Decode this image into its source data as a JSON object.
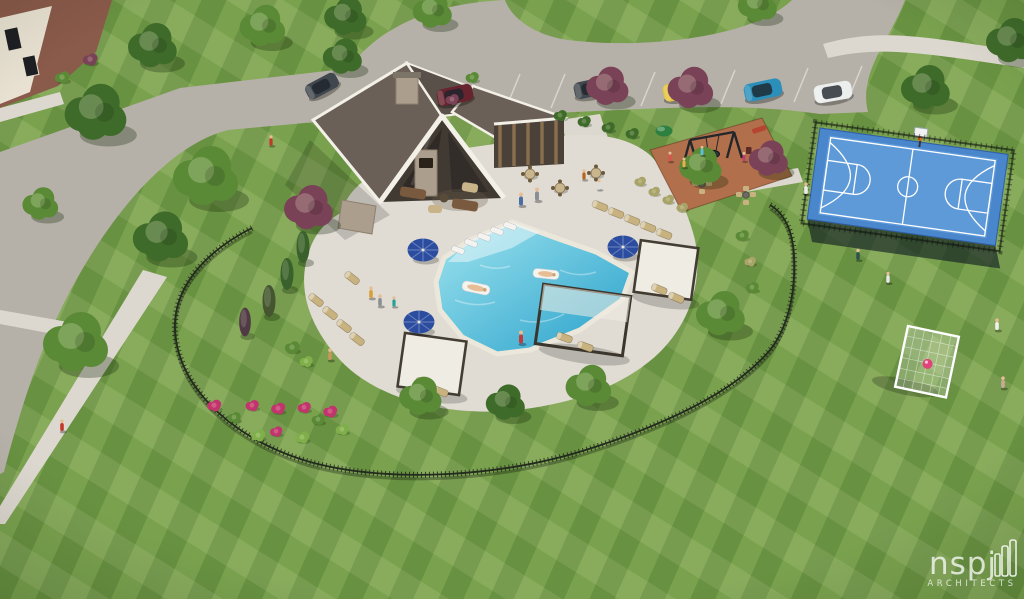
{
  "image": {
    "alt": "Aerial architectural rendering of a community amenity center: clubhouse with gabled roofs, resort-style pool with tanning ledge, blue umbrellas and cabanas, playground, blue basketball sport court, soccer goal lawn, parking with cars, and striped mown lawns"
  },
  "watermark": {
    "name": "nspj",
    "tagline": "ARCHITECTS"
  },
  "palette": {
    "lawn": "#7aa24e",
    "road": "#b6b1a8",
    "sidewalk": "#ddd8cf",
    "deck": "#e0dcd4",
    "pool_shallow": "#9fe4ee",
    "pool_deep": "#27a0cb",
    "coping": "#ece7db",
    "court": "#4a86cc",
    "court_light": "#5e9ad8",
    "court_line": "#ffffff",
    "roof": "#6b6057",
    "roof_dark": "#59504a",
    "trim": "#f3f0e8",
    "wall": "#413a33",
    "stone": "#ab9e8c",
    "wood": "#8a6f4e",
    "mulch": "#b16f4b",
    "umbrella": "#2c4d9f",
    "fence": "#232a1e",
    "lounger": "#c7b280",
    "canopy": "#f0ede4",
    "tree": "#5a8a36",
    "tree_dark": "#3f6b2a",
    "tree_purple": "#7a4257",
    "flower": "#c2346d",
    "fern": "#7fae4a",
    "grass_tuft": "#a8a368",
    "goal": "#ffffff",
    "ball": "#e0447a",
    "skin": "#e6bd95",
    "car_maroon": "#67242f",
    "car_gray": "#41474e",
    "car_yellow": "#e4c23a",
    "car_teal": "#2b8fba",
    "car_white": "#eceeee",
    "house_wall": "#e9e2d2",
    "house_roof": "#8a5a4a"
  },
  "scene": {
    "features": [
      "clubhouse with gabled roofs and stone chimney",
      "resort-style pool with tanning ledge and floats",
      "blue shade umbrellas",
      "cabana pergolas",
      "chaise lounges",
      "ornamental iron perimeter fence",
      "flower beds",
      "playground with swing set on mulch",
      "fire-pit seating",
      "blue basketball sport court",
      "parking row with five cars",
      "soccer goal on event lawn",
      "striped mown lawn",
      "neighborhood street and sidewalks"
    ]
  }
}
